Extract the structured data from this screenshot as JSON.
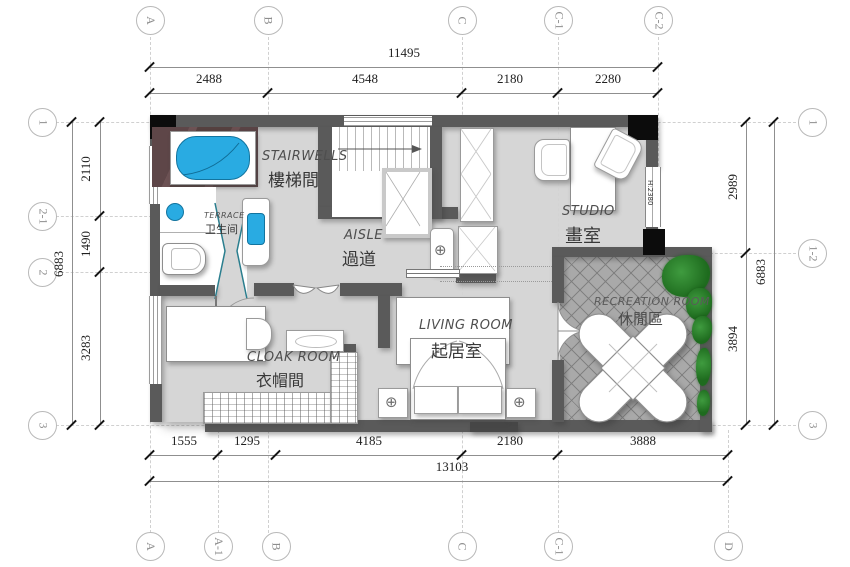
{
  "axes": {
    "top": [
      "A",
      "B",
      "C",
      "C-1",
      "C-2"
    ],
    "bottom": [
      "A",
      "A-1",
      "B",
      "C",
      "C-1",
      "D"
    ],
    "left": [
      "1",
      "2-1",
      "2",
      "3"
    ],
    "right": [
      "1",
      "1-2",
      "3"
    ]
  },
  "dims": {
    "top": {
      "total": "11495",
      "segments": [
        "2488",
        "4548",
        "2180",
        "2280"
      ]
    },
    "bottom": {
      "total": "13103",
      "segments": [
        "1555",
        "1295",
        "4185",
        "2180",
        "3888"
      ]
    },
    "left": {
      "total": "6883",
      "segments": [
        "2110",
        "1490",
        "3283"
      ]
    },
    "right": {
      "total": "6883",
      "segments": [
        "2989",
        "3894"
      ]
    }
  },
  "rooms": {
    "stairwell": {
      "en": "STAIRWELLS",
      "zh": "樓梯間"
    },
    "bathroom": {
      "en": "TERRACE",
      "zh": "卫生间"
    },
    "aisle": {
      "en": "AISLE",
      "zh": "過道"
    },
    "studio": {
      "en": "STUDIO",
      "zh": "畫室"
    },
    "living": {
      "en": "LIVING ROOM",
      "zh": "起居室"
    },
    "cloak": {
      "en": "CLOAK ROOM",
      "zh": "衣帽間"
    },
    "recreation": {
      "en": "RECREATION ROOM",
      "zh": "休閒區"
    }
  },
  "annotations": {
    "window_height": "H:2380"
  },
  "colors": {
    "wall": "#5a5a5a",
    "column": "#0c0c0c",
    "floor": "#d6d6d6",
    "recreation_floor": "#a9a9a9",
    "fixture_blue": "#29abe2",
    "plant_green": "#2e8b2e",
    "marble_brown": "#5c4446"
  }
}
